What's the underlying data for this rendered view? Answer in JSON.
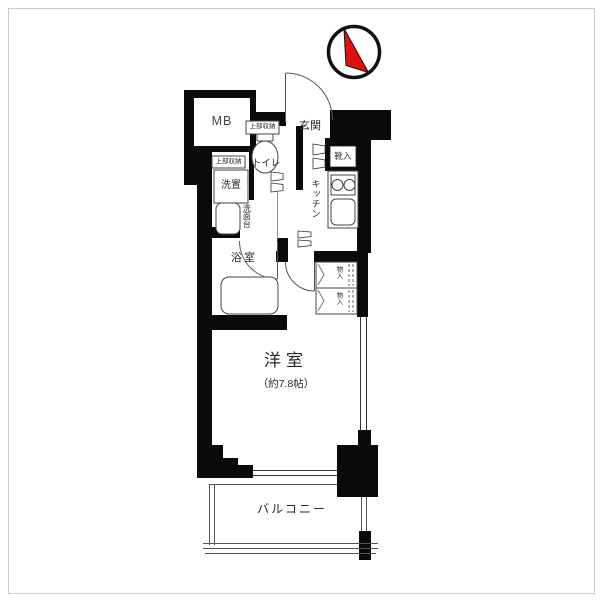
{
  "plan": {
    "labels": {
      "mb": "MB",
      "entrance": "玄関",
      "shoe_cabinet": "靴入",
      "kitchen": "キッチン",
      "toilet": "トイレ",
      "upper_storage_toilet": "上部収納",
      "upper_storage_laundry": "上部収納",
      "laundry": "洗置",
      "washstand": "洗面台",
      "bathroom": "浴室",
      "closet_upper": "物入",
      "closet_lower": "物入",
      "main_room": "洋室",
      "main_room_size": "（約7.8帖）",
      "balcony": "バルコニー"
    },
    "colors": {
      "wall": "#0a0a0a",
      "line": "#4a4a4a",
      "thin": "#6a6a6a",
      "compass_red": "#e01010",
      "frame": "#cccccc"
    }
  }
}
